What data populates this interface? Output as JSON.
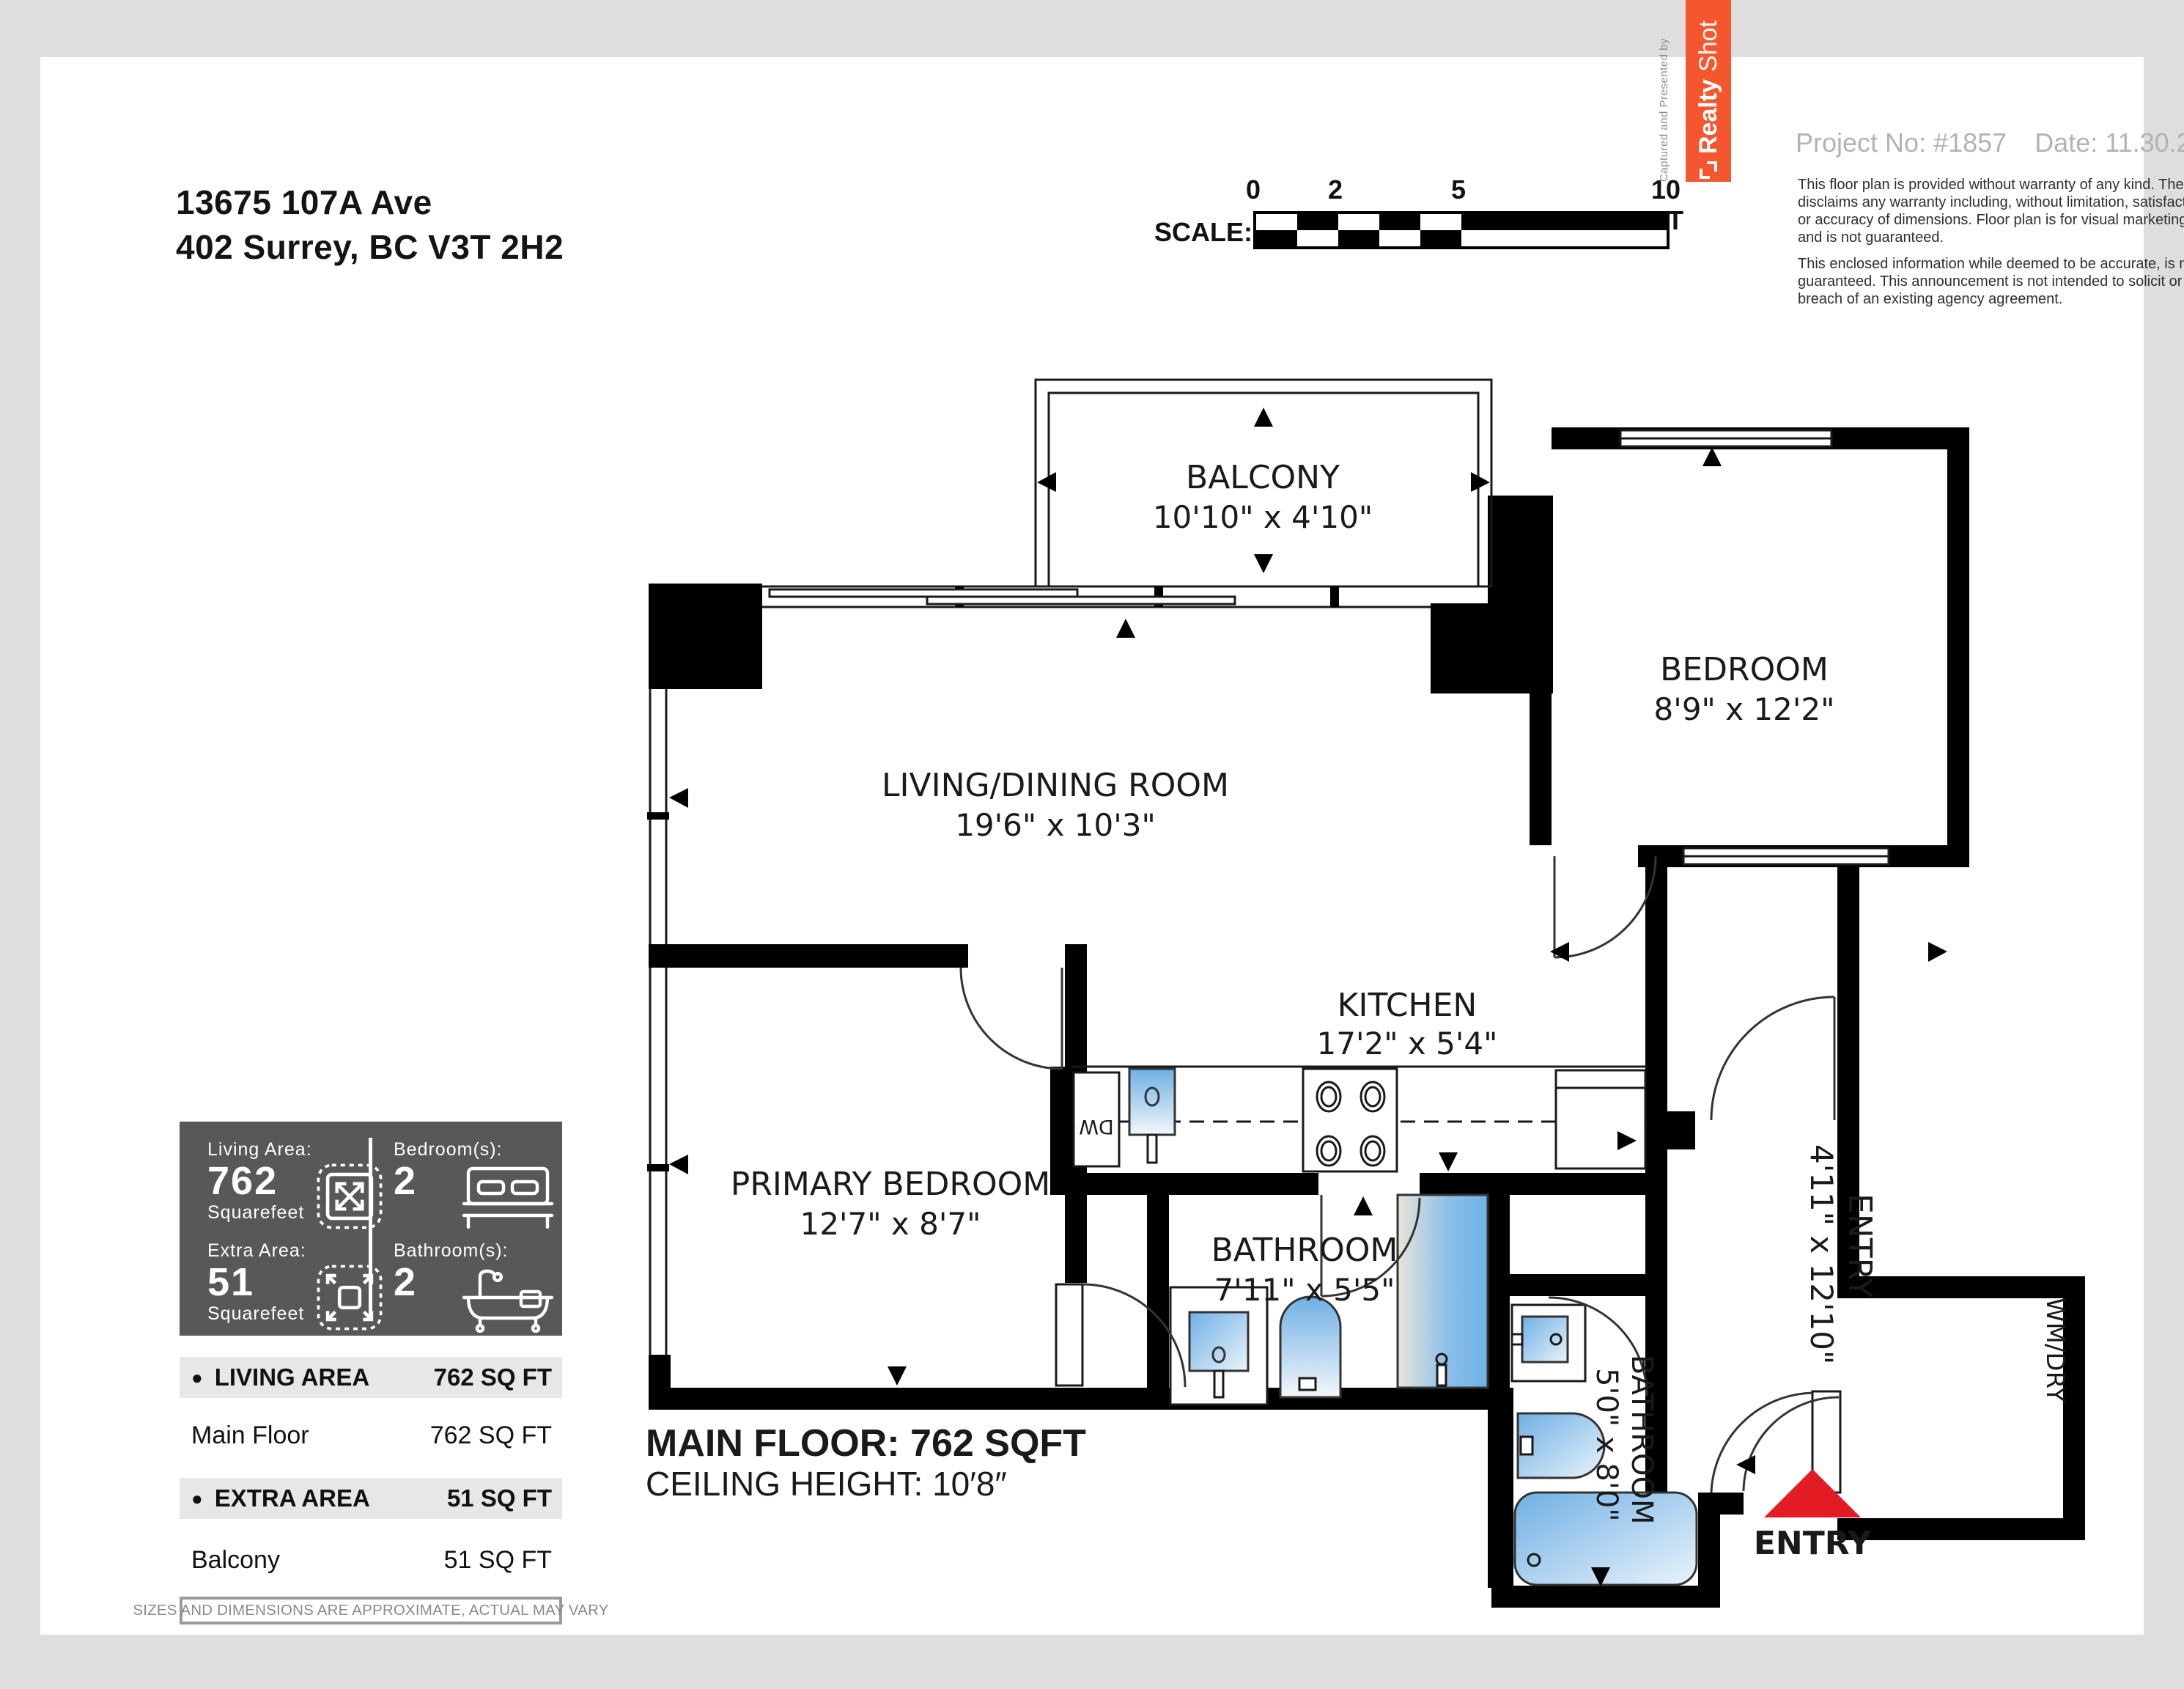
{
  "header": {
    "address_line1": "13675 107A Ave",
    "address_line2": "402 Surrey, BC V3T 2H2",
    "project_no": "Project No: #1857",
    "date": "Date: 11.30.2025",
    "disclaimer1": "This floor plan is provided without warranty of any kind. The contractor disclaims any warranty including, without limitation, satisfactory quality or accuracy of dimensions. Floor plan is for visual marketing purposes and is not guaranteed.",
    "disclaimer2": "This enclosed information while deemed to be accurate, is not guaranteed. This announcement is not intended to solicit or induce breach of an existing agency agreement.",
    "captured_by": "Captured and Presented by",
    "brand_realty": "Realty",
    "brand_shot": "Shot"
  },
  "scale_bar": {
    "label": "SCALE:",
    "tick0": "0",
    "tick2": "2",
    "tick5": "5",
    "tick10": "10 FT"
  },
  "stats": {
    "living": {
      "label": "Living Area:",
      "value": "762",
      "unit": "Squarefeet"
    },
    "bedrooms": {
      "label": "Bedroom(s):",
      "value": "2"
    },
    "extra": {
      "label": "Extra Area:",
      "value": "51",
      "unit": "Squarefeet"
    },
    "bathrooms": {
      "label": "Bathroom(s):",
      "value": "2"
    }
  },
  "area_table": {
    "bullet": "●",
    "living_header": "LIVING AREA",
    "living_total": "762 SQ FT",
    "living_row_name": "Main Floor",
    "living_row_value": "762 SQ FT",
    "extra_header": "EXTRA AREA",
    "extra_total": "51 SQ FT",
    "extra_row_name": "Balcony",
    "extra_row_value": "51 SQ FT",
    "note": "SIZES AND DIMENSIONS ARE APPROXIMATE, ACTUAL MAY VARY"
  },
  "floor": {
    "title": "MAIN FLOOR: 762 SQFT",
    "ceiling": "CEILING HEIGHT: 10′8″",
    "entry_label": "ENTRY",
    "dw_label": "DW",
    "wm_label": "WM/DRY"
  },
  "rooms": [
    {
      "name": "BALCONY",
      "dims": "10'10\" x 4'10\""
    },
    {
      "name": "BEDROOM",
      "dims": "8'9\" x 12'2\""
    },
    {
      "name": "LIVING/DINING ROOM",
      "dims": "19'6\" x 10'3\""
    },
    {
      "name": "KITCHEN",
      "dims": "17'2\" x 5'4\""
    },
    {
      "name": "PRIMARY BEDROOM",
      "dims": "12'7\" x 8'7\""
    },
    {
      "name": "BATHROOM",
      "dims": "7'11\" x 5'5\""
    },
    {
      "name": "BATHROOM",
      "dims": "5'0\" x 8'0\""
    },
    {
      "name": "ENTRY",
      "dims": "4'11\" x 12'10\""
    },
    {
      "name": "WM/DRY",
      "dims": ""
    }
  ],
  "colors": {
    "accent_orange": "#f4572e",
    "entry_red": "#e31b23",
    "fixture_blue": "#6fb0e4",
    "panel_gray": "#58585a",
    "page_gray": "#dedede"
  }
}
